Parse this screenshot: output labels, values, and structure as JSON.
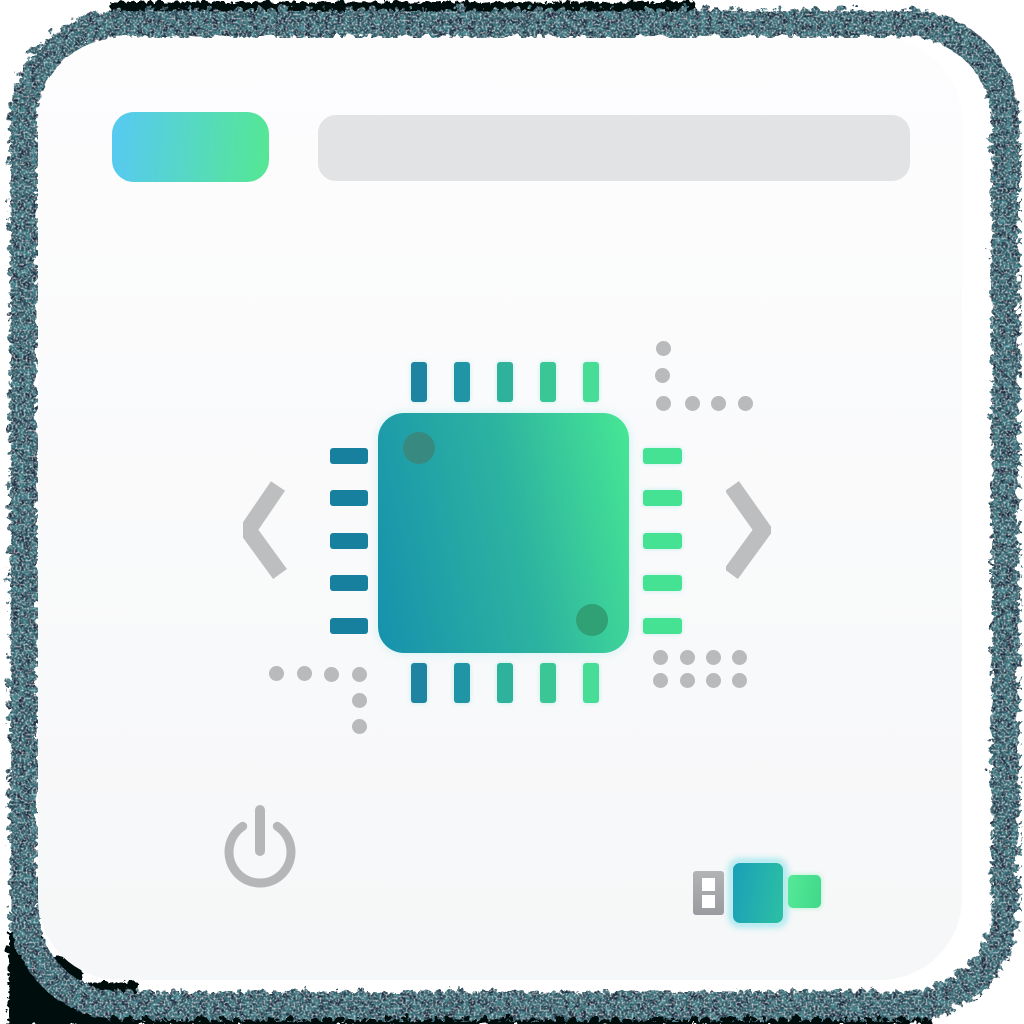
{
  "meta": {
    "description": "Skeleton app card mock with grunge frame, CPU chip illustration, carousel chevrons, power button and USB drive icon",
    "visible_text": ""
  },
  "frame": {
    "ink": "#1a2f44",
    "black_edge": "#060708"
  },
  "card": {
    "background": "linear-gradient(180deg,#fdfdfe 0%,#f6f7f8 100%)"
  },
  "toolbar": {
    "pill_background": "linear-gradient(95deg,#57c9f3 0%,#55e793 100%)",
    "bar_background": "#e2e3e5"
  },
  "chip": {
    "body_background": "linear-gradient(78deg,#1691ad 0%,#2db3a0 55%,#47e794 100%)",
    "corner_dot_top": "#38897f",
    "corner_dot_bottom": "#30a175",
    "pins": {
      "top": [
        "#1e84a2",
        "#2095a6",
        "#2eb29b",
        "#3bc795",
        "#48dd96"
      ],
      "bottom": [
        "#1e84a2",
        "#2095a6",
        "#2eb29b",
        "#3bc795",
        "#48dd96"
      ],
      "left": [
        "#17809e",
        "#17809e",
        "#17809e",
        "#17809e",
        "#17809e"
      ],
      "right": [
        "#46e294",
        "#46e294",
        "#46e294",
        "#46e294",
        "#46e294"
      ]
    }
  },
  "chevrons": {
    "color": "#bcbec0"
  },
  "decor": {
    "dot_color": "#b9babc"
  },
  "power": {
    "color": "#b5b6b8"
  },
  "usb": {
    "plug_background": "linear-gradient(180deg,#b2b4b6,#999b9e)",
    "hole_color": "#ffffff",
    "body_background": "linear-gradient(100deg,#1b9fb9,#2cc0a3)",
    "cap_background": "linear-gradient(100deg,#55e997,#3fd98a)"
  }
}
